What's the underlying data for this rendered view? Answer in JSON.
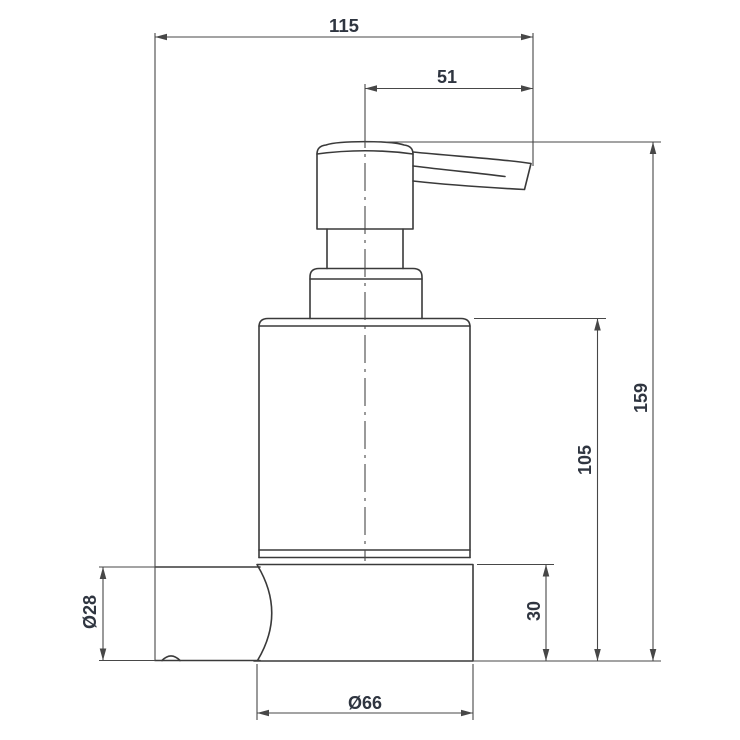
{
  "colors": {
    "line": "#3a3a3a",
    "dim": "#474747",
    "text": "#2f3540",
    "background": "#ffffff"
  },
  "drawing": {
    "dimensions": {
      "total_width": "115",
      "spout_reach": "51",
      "total_height": "159",
      "bottle_height": "105",
      "holder_height": "30",
      "arm_diameter": "Ø28",
      "holder_diameter": "Ø66"
    }
  }
}
